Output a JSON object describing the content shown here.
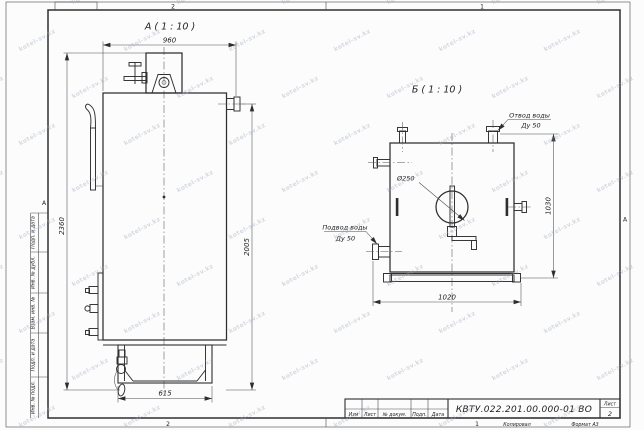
{
  "sheet": {
    "watermark": "kotel-sv.kz",
    "zones": {
      "top_left": "2",
      "top_right": "1",
      "bottom_left": "2",
      "bottom_right": "1",
      "left": "А",
      "right": "А"
    },
    "margin_columns": [
      "Подп. и дата",
      "Инв. № дубл.",
      "Взам. инв. №",
      "Подп. и дата",
      "Инв. № подл."
    ],
    "title_block": {
      "doc_number": "КВТУ.022.201.00.000-01 ВО",
      "columns": [
        "Изм",
        "Лист",
        "№ докум.",
        "Подп.",
        "Дата"
      ],
      "sheet_label": "Лист",
      "sheet_number": "2"
    },
    "footer": {
      "copied": "Копировал",
      "format": "Формат А3"
    }
  },
  "views": {
    "a": {
      "title": "А ( 1 : 10 )",
      "dims": {
        "width": "960",
        "total_height": "2360",
        "right_height": "2005",
        "base_width": "615"
      }
    },
    "b": {
      "title": "Б ( 1 : 10 )",
      "dims": {
        "width": "1020",
        "height": "1030",
        "flue_diameter": "Ø250"
      },
      "labels": {
        "outlet_line1": "Отвод воды",
        "outlet_line2": "Ду 50",
        "inlet_line1": "Подвод воды",
        "inlet_line2": "Ду 50"
      }
    }
  }
}
